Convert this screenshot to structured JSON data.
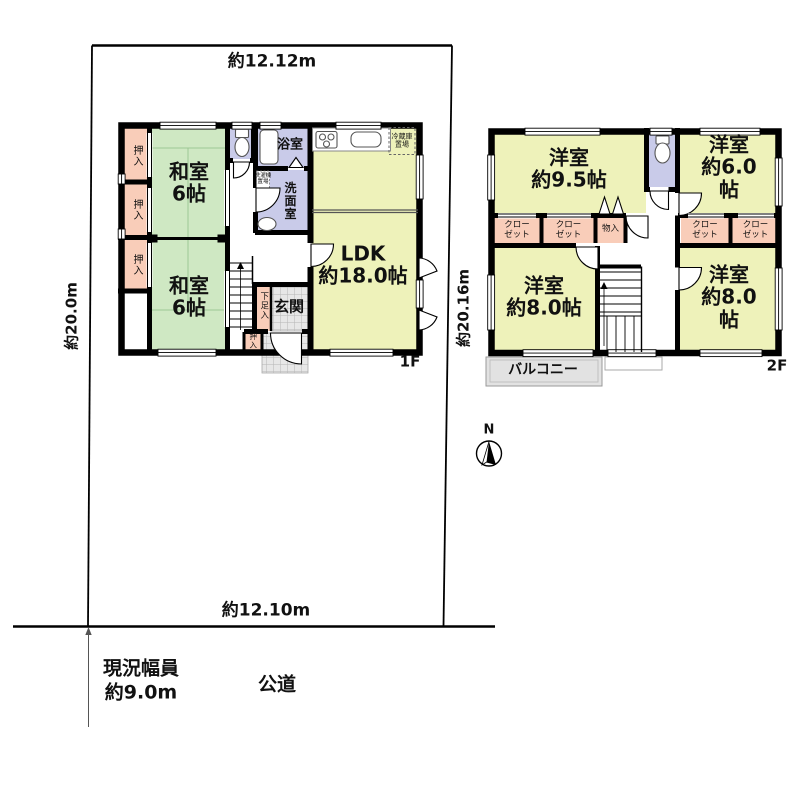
{
  "site": {
    "dim_top": "約12.12m",
    "dim_bottom": "約12.10m",
    "dim_left": "約20.0m",
    "dim_right": "約20.16m",
    "road_width": "現況幅員\n約9.0m",
    "road_label": "公道",
    "compass_label": "N"
  },
  "floor1": {
    "floor_label": "1F",
    "washitsu_top": "和室\n6帖",
    "washitsu_bottom": "和室\n6帖",
    "ldk": "LDK\n約18.0帖",
    "bath": "浴室",
    "washroom": "洗面室",
    "genkan": "玄関",
    "shoe_closet": "下足入",
    "closet1": "押入",
    "closet2": "押入",
    "closet3": "押入",
    "closet4": "押入",
    "fridge_space": "冷蔵庫\n置場",
    "washer_space": "洗濯機\n置場"
  },
  "floor2": {
    "floor_label": "2F",
    "room_nw": "洋室\n約9.5帖",
    "room_ne": "洋室\n約6.0帖",
    "room_sw": "洋室\n約8.0帖",
    "room_se": "洋室\n約8.0帖",
    "closet1": "クロー\nゼット",
    "closet2": "クロー\nゼット",
    "closet3": "クロー\nゼット",
    "closet4": "クロー\nゼット",
    "storage": "物入",
    "balcony": "バルコニー"
  },
  "colors": {
    "wall": "#000000",
    "tatami_green": "#cfe8c3",
    "western_yellow": "#eef2ba",
    "closet_pink": "#f9cdb9",
    "wet_area_lavender": "#c9cbe9",
    "tile_gray": "#e7e7e7",
    "balcony_gray": "#e2e2e2"
  }
}
